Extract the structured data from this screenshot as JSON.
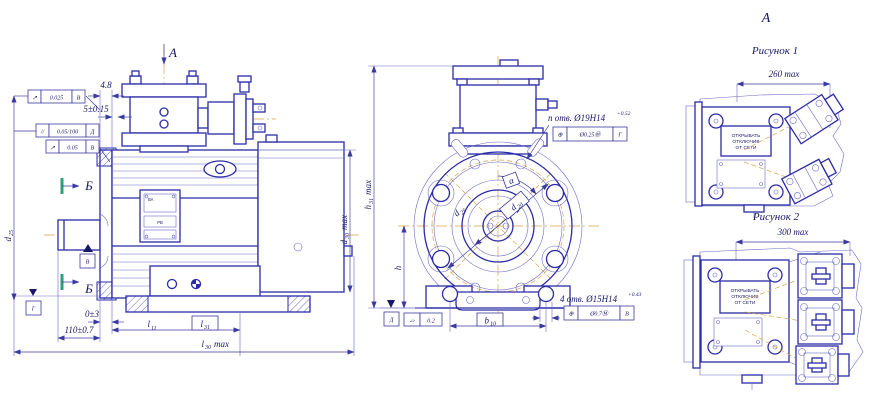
{
  "sheet": {
    "background": "#ffffff",
    "line_color": "#2b2ba8",
    "centerline_color": "#d9a441",
    "section_mark_color": "#2f9e7a"
  },
  "labels": {
    "view_arrow_a": "А",
    "view_a_right": "А",
    "section_b_top": "Б",
    "section_b_bottom": "Б",
    "figure1_title": "Рисунок 1",
    "figure1_width": "260 max",
    "figure2_title": "Рисунок 2",
    "figure2_width": "300 max"
  },
  "warning_plate": {
    "line1": "ОТКРЫВАТЬ",
    "line2": "ОТКЛЮЧИВ",
    "line3": "ОТ СЕТИ"
  },
  "nameplate": {
    "series": "ВА",
    "marking": "РВ"
  },
  "side_view": {
    "dim_flange_thickness": "4.8",
    "dim_spigot": "5±0.15",
    "dim_zero": "0±3",
    "dim_shaft": "110±0.7",
    "l11": {
      "base": "l",
      "sub": "11"
    },
    "l31": {
      "base": "l",
      "sub": "31"
    },
    "l30": {
      "base": "l",
      "sub": "30",
      "suffix": "max"
    },
    "d25": {
      "base": "d",
      "sub": "25"
    },
    "d30": {
      "base": "d",
      "sub": "30",
      "suffix": "max"
    },
    "frame_runout_top": {
      "symbol": "↗",
      "value": "0.025",
      "datum": "В"
    },
    "frame_parallel": {
      "symbol": "//",
      "value": "0.05/100",
      "datum": "Д"
    },
    "frame_runout_bottom": {
      "symbol": "↗",
      "value": "0.05",
      "datum": "В"
    },
    "datum_v": "В",
    "datum_g": "Г"
  },
  "front_view": {
    "h31": {
      "base": "h",
      "sub": "31",
      "suffix": "max"
    },
    "h": {
      "base": "h"
    },
    "d25": {
      "base": "d",
      "sub": "25"
    },
    "d20": {
      "base": "d",
      "sub": "20"
    },
    "alpha": "α",
    "b10": {
      "base": "b",
      "sub": "10"
    },
    "flange_holes": {
      "note": "n отв. Ø19H14",
      "tolerance": "+0.52",
      "frame": {
        "symbol": "⊕",
        "value": "Ø0.25Ⓜ",
        "datum": "Г"
      }
    },
    "foot_holes": {
      "note": "4 отв. Ø15H14",
      "tolerance": "+0.43",
      "frame": {
        "symbol": "⊕",
        "value": "Ø0.7Ⓜ",
        "datum": "В"
      }
    },
    "flatness": {
      "symbol": "▱",
      "value": "0.2"
    },
    "datum_d": "Д"
  }
}
